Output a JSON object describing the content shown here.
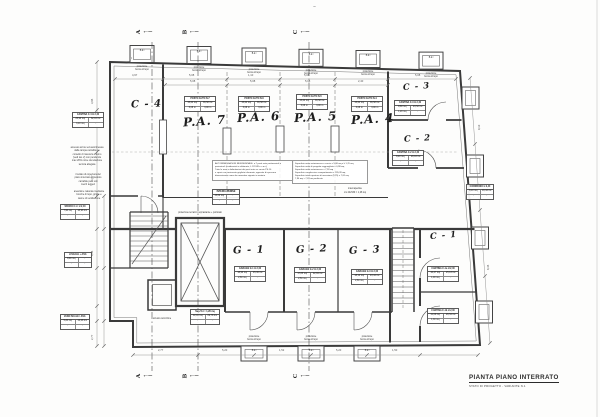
{
  "title_block": {
    "line1": "PIANTA PIANO INTERRATO",
    "line2": "STATO DI PROGETTO - VARIANTE N.1"
  },
  "rooms": {
    "c4": "C - 4",
    "pa7": "P.A. 7",
    "pa6": "P.A. 6",
    "pa5": "P.A. 5",
    "pa4": "P.A. 4",
    "c3": "C - 3",
    "c2": "C - 2",
    "c1": "C - 1",
    "g1": "G - 1",
    "g2": "G - 2",
    "g3": "G - 3"
  },
  "sections": {
    "a": "A",
    "b": "B",
    "c": "C"
  },
  "lightwell": {
    "box_label": "B.d.l",
    "caption": [
      "proiezione",
      "bocca di lupo"
    ]
  },
  "labels": {
    "shaft": "proiezione terrazzo soprastante + porticato",
    "intercapedine": "intercapedine",
    "intercapedine2": "cm 24x530 = 1,28 mq",
    "scivolo": "scivolo carrozzine"
  },
  "tables": {
    "t_c4": {
      "title": "CANTINA C-4 H 2,40",
      "a": "25,90 mq",
      "b": "62,16 mc",
      "c": "3,10 mq",
      "d": "-"
    },
    "t_pa7": {
      "title": "POSTO AUTO N.7",
      "a": "15,24 mq",
      "b": "36,58 mc",
      "c": "5,08 m",
      "d": "3,00 m"
    },
    "t_pa6": {
      "title": "POSTO AUTO N.6",
      "a": "15,24 mq",
      "b": "36,58 mc",
      "c": "5,08 m",
      "d": "3,00 m"
    },
    "t_pa5": {
      "title": "POSTO AUTO N.5",
      "a": "15,24 mq",
      "b": "36,58 mc",
      "c": "5,08 m",
      "d": "3,00 m"
    },
    "t_pa4": {
      "title": "POSTO AUTO N.4",
      "a": "15,24 mq",
      "b": "36,58 mc",
      "c": "5,08 m",
      "d": "3,00 m"
    },
    "t_c3": {
      "title": "CANTINA C-3 H 2,40",
      "a": "9,80 mq",
      "b": "23,52 mc",
      "c": "1,20 mq",
      "d": "-"
    },
    "t_c2": {
      "title": "CANTINA C-2 H 2,40",
      "a": "8,40 mq",
      "b": "20,16 mc",
      "c": "-",
      "d": "-"
    },
    "t_c1a": {
      "title": "CANTINA C-1a H 2,40",
      "a": "10,47 mq",
      "b": "25,13 mc",
      "c": "1,00 mq",
      "d": "-"
    },
    "t_c1b": {
      "title": "CANTINA C-1b H 2,40",
      "a": "11,06 mq",
      "b": "26,54 mc",
      "c": "1,30 mq",
      "d": "-"
    },
    "t_g1": {
      "title": "GARAGE G-1 H 2,40",
      "a": "18,90 mq",
      "b": "45,36 mc",
      "c": "2,60 mq",
      "d": "-"
    },
    "t_g2": {
      "title": "GARAGE G-2 H 2,40",
      "a": "17,85 mq",
      "b": "42,84 mc",
      "c": "2,50 mq",
      "d": "-"
    },
    "t_g3": {
      "title": "GARAGE G-3 H 2,40",
      "a": "18,10 mq",
      "b": "43,44 mc",
      "c": "2,60 mq",
      "d": "-"
    },
    "t_left2": {
      "title": "SPAZIO C.U. H 2,40",
      "a": "7,90 mq",
      "b": "18,96 mc",
      "c": "-",
      "d": "-"
    },
    "t_left3": {
      "title": "H SCALE + ASC.",
      "a": "8,90 mq",
      "b": "-",
      "c": "-",
      "d": "-"
    },
    "t_left4": {
      "title": "VANO SCALE / ASC.",
      "a": "5,20 mq",
      "b": "12,48 mc",
      "c": "-",
      "d": "-"
    },
    "t_corr": {
      "title": "CORRIDOIO H 2,40",
      "a": "8,10 mq",
      "b": "19,44 mc",
      "c": "-",
      "d": "-"
    },
    "t_mid": {
      "title": "INTERCAPEDINE",
      "a": "15,66 mq",
      "b": "-",
      "c": "-",
      "d": "-"
    },
    "t_shaft": {
      "title": "Sup.Tot = 1,28 mq",
      "a": "12,41 mq",
      "b": "29,78 mc",
      "c": "-",
      "d": "-"
    }
  },
  "notes_a": [
    "AUTORIMESSA NON RESIDENZIALE: n.7 posti auto pertinenziali e",
    "perimetrali (evidenziati in elaborato, L.122-89 e s.m.i.)",
    "Tutte le aree e delimitazioni dei posti auto su corsia PS.10",
    "e spazi con pavimento grigliato informato, apposite di spessore",
    "dimensionato come da normativa vigente in materia"
  ],
  "notes_b": [
    "Superficie netta autorimessa e corsie = 5,08 mq x h 1,70 mq",
    "Superficie netta di progetto ragguagliata = 0,98 mq",
    "Superficie netta autorimessa = 7,28 mq",
    "Superficie complessiva compartimento = 195,28 mq",
    "Superficie totale aperture di areazione (1/25) = 7,81 mq",
    "7,96 mq > 7,81 mq  verificato"
  ],
  "para_1": [
    "accesso ai box ed autorimessa",
    "dalla rampa carrabile su",
    "corsello di manovra interno",
    "(vedi tav. 2) con pendenza",
    "max 20% come da relazione",
    "tecnica allegata"
  ],
  "para_2": [
    "il solaio di copertura del",
    "piano interrato e' previsto",
    "carrabile per i soli",
    "mezzi leggeri"
  ],
  "para_3": [
    "areazione naturale mediante",
    "bocche di lupo, griglie e",
    "canne di ventilazione"
  ],
  "dims": {
    "top": [
      "4,97",
      "5,08",
      "1,10",
      "5,08",
      "5,08"
    ],
    "bottom": [
      "2,77",
      "5,20",
      "1,52",
      "5,20",
      "1,50"
    ],
    "left": [
      "3,95",
      "11,97",
      "4,45",
      "2,77"
    ],
    "right": [
      "9,10",
      "8,35"
    ],
    "inner": [
      "5,08",
      "5,08",
      "5,08",
      "2,40"
    ]
  }
}
